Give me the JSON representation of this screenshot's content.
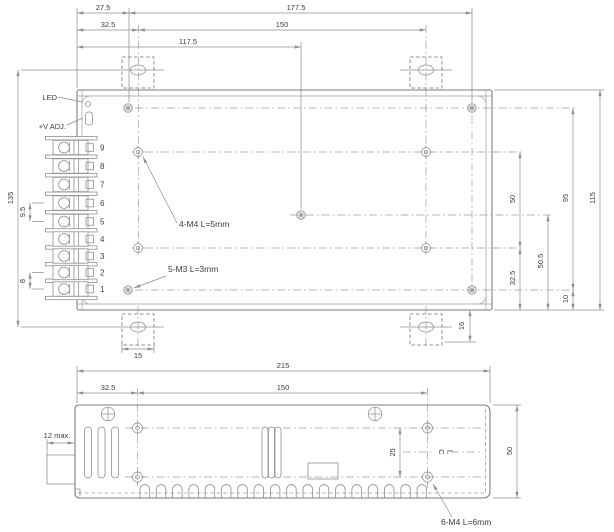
{
  "drawing_type": "power-supply-mechanical-drawing",
  "colors": {
    "line": "#8f8f8f",
    "outline": "#7d7d7d",
    "text": "#3c3c3c",
    "background": "#ffffff"
  },
  "top_view": {
    "labels": {
      "led": "LED",
      "v_adj": "+V ADJ."
    },
    "terminals": [
      "9",
      "8",
      "7",
      "6",
      "5",
      "4",
      "3",
      "2",
      "1"
    ],
    "annotations": {
      "m4": "4-M4 L=5mm",
      "m3": "5-M3 L=3mm"
    },
    "dims": {
      "d27_5": "27.5",
      "d177_5": "177.5",
      "d32_5": "32.5",
      "d150": "150",
      "d117_5": "117.5",
      "d135": "135",
      "d9_5": "9.5",
      "d8": "8",
      "d50": "50",
      "d32_5r": "32.5",
      "d50_5": "50.5",
      "d95": "95",
      "d115": "115",
      "d10": "10",
      "d16": "16",
      "d15": "15"
    }
  },
  "bottom_view": {
    "dims": {
      "d215": "215",
      "d32_5": "32.5",
      "d150": "150",
      "d25": "25",
      "d50": "50",
      "d12max": "12 max."
    },
    "annotations": {
      "m4": "6-M4 L=6mm",
      "cl_c": "C",
      "cl_l": "L"
    }
  }
}
